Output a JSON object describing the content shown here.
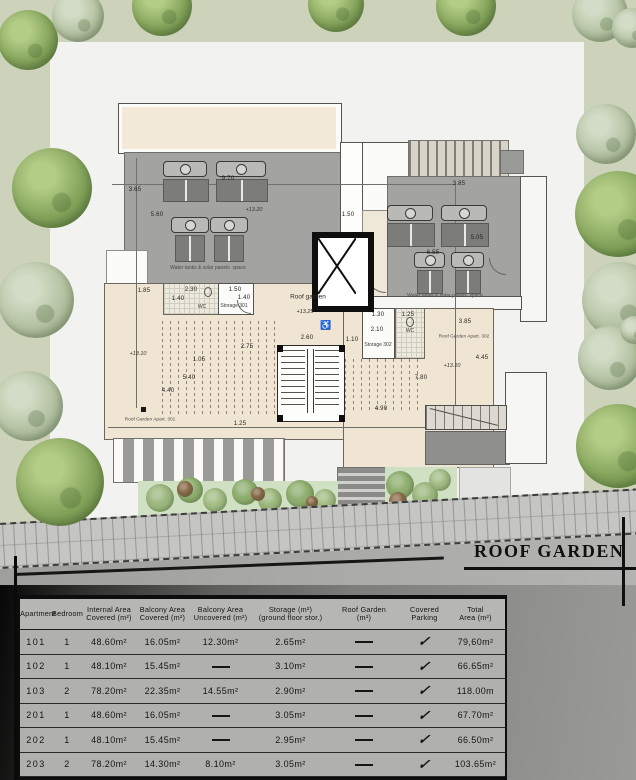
{
  "title": "ROOF GARDEN",
  "plan": {
    "labels": {
      "water_tanks_left": "Water tanks & solar panels  space",
      "water_tanks_right": "Water tanks & solar panels  space",
      "roof_garden_stair": "Roof garden",
      "apt301": "Roof Garden Apart. 301",
      "apt302": "Roof Garden Apart. 302",
      "storage301": "Storage 301",
      "storage302": "Storage 302",
      "wc_left": "WC",
      "wc_right": "WC"
    },
    "levels": {
      "roof_left": "+13.20",
      "stair": "+13.25",
      "garden_left": "+13.10",
      "garden_right": "+13.10"
    },
    "dimensions": {
      "d365": "3.65",
      "d560": "5.60",
      "d970": "9.70",
      "d150a": "1.50",
      "d385a": "3.85",
      "d505": "5.05",
      "d655": "6.55",
      "d185": "1.85",
      "d230": "2.30",
      "d140a": "1.40",
      "d150b": "1.50",
      "d140b": "1.40",
      "d275": "2.75",
      "d105": "1.05",
      "d540": "5.40",
      "d440": "4.40",
      "d125a": "1.25",
      "d260": "2.60",
      "d110": "1.10",
      "d130": "1.30",
      "d125b": "1.25",
      "d210": "2.10",
      "d385b": "3.85",
      "d445": "4.45",
      "d780": "7.80",
      "d490": "4.90"
    }
  },
  "table": {
    "headers": [
      "Apartment",
      "Bedroom",
      "Internal Area\nCovered (m²)",
      "Balcony Area\nCovered (m²)",
      "Balcony Area\nUncovered (m²)",
      "Storage (m²)\n(ground floor stor.)",
      "Roof Garden\n(m²)",
      "Covered\nParking",
      "Total\nArea (m²)"
    ],
    "rows": [
      [
        "101",
        "1",
        "48.60m²",
        "16.05m²",
        "12.30m²",
        "2.65m²",
        "—",
        "✓",
        "79,60m²"
      ],
      [
        "102",
        "1",
        "48.10m²",
        "15.45m²",
        "—",
        "3.10m²",
        "—",
        "✓",
        "66.65m²"
      ],
      [
        "103",
        "2",
        "78.20m²",
        "22.35m²",
        "14.55m²",
        "2.90m²",
        "—",
        "✓",
        "118.00m"
      ],
      [
        "201",
        "1",
        "48.60m²",
        "16.05m²",
        "—",
        "3.05m²",
        "—",
        "✓",
        "67.70m²"
      ],
      [
        "202",
        "1",
        "48.10m²",
        "15.45m²",
        "—",
        "2.95m²",
        "—",
        "✓",
        "66.50m²"
      ],
      [
        "203",
        "2",
        "78.20m²",
        "14.30m²",
        "8.10m²",
        "3.05m²",
        "—",
        "✓",
        "103.65m²"
      ]
    ],
    "partial_row": [
      "301",
      "",
      "",
      "",
      "",
      "",
      "55.70m²",
      "✓",
      ""
    ]
  },
  "colors": {
    "grass": "#ccd3ba",
    "site": "#f2f2f0",
    "roof_gray": "#a3a3a1",
    "terrace_beige": "#f0e5d3",
    "panel_dark": "#7c7c7a",
    "table_bg": "#b0b0ae",
    "title_black": "#101010"
  }
}
